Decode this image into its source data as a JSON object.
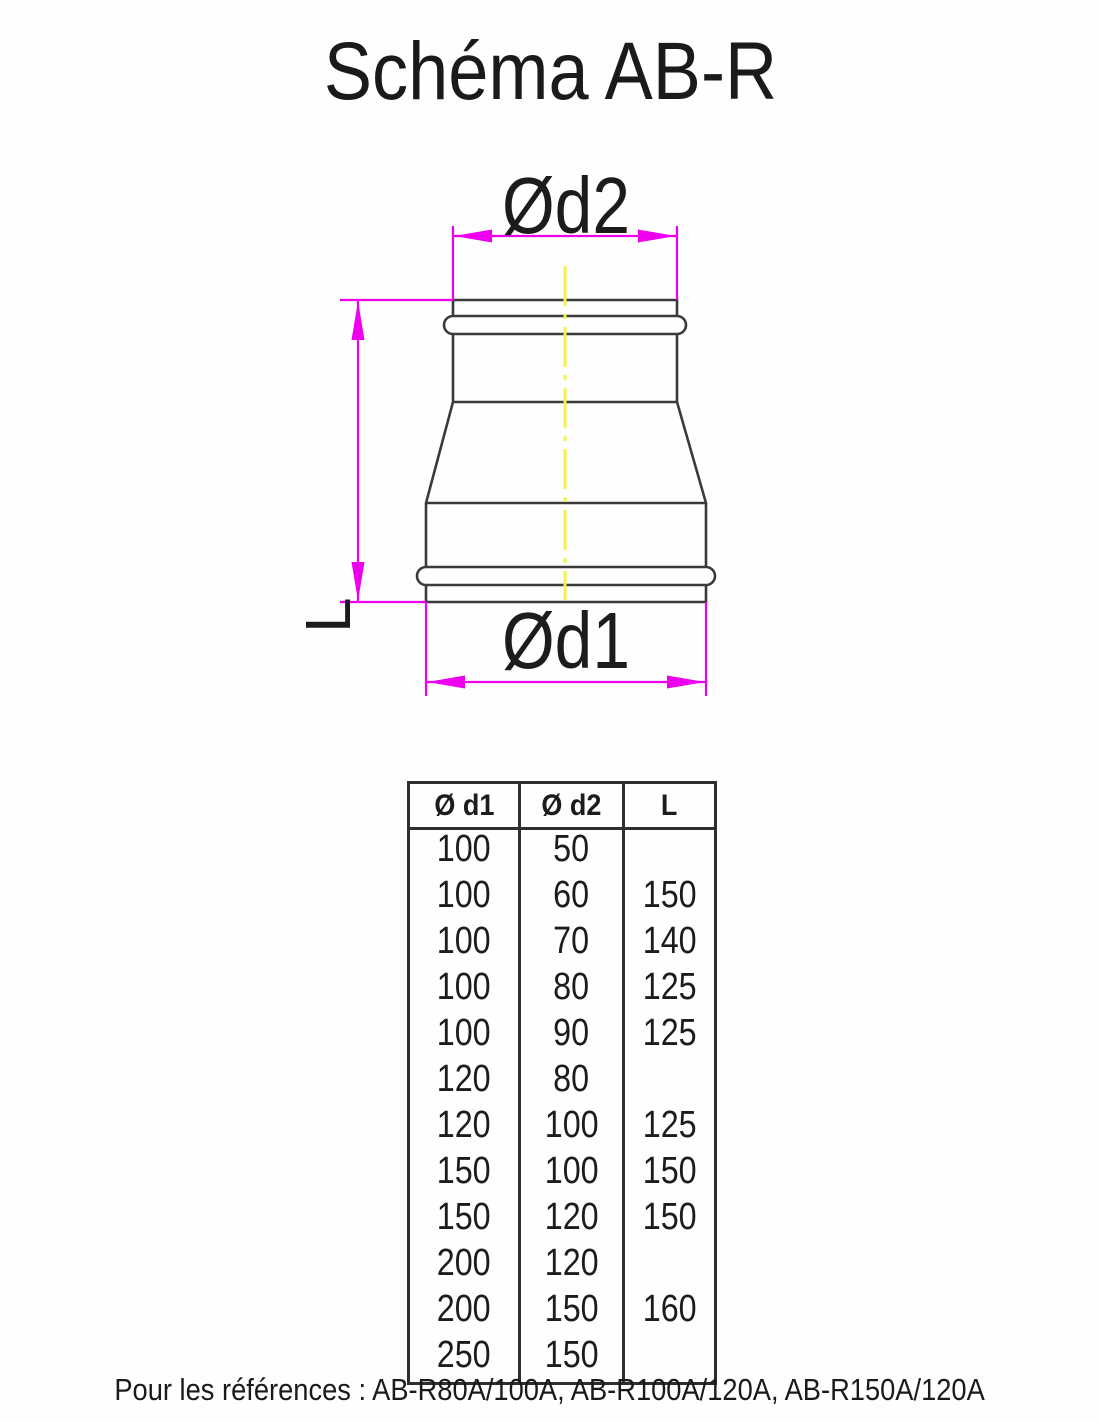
{
  "page": {
    "title": "Schéma AB-R",
    "caption": "Pour les références : AB-R80A/100A, AB-R100A/120A, AB-R150A/120A"
  },
  "diagram": {
    "labels": {
      "d2": "Ød2",
      "d1": "Ød1",
      "length": "L"
    },
    "colors": {
      "dimension": "#ee00ee",
      "centerline": "#f4f446",
      "outline": "#3a3a3a"
    }
  },
  "table": {
    "headers": [
      "Ø d1",
      "Ø d2",
      "L"
    ],
    "rows": [
      [
        "100",
        "50",
        ""
      ],
      [
        "100",
        "60",
        "150"
      ],
      [
        "100",
        "70",
        "140"
      ],
      [
        "100",
        "80",
        "125"
      ],
      [
        "100",
        "90",
        "125"
      ],
      [
        "120",
        "80",
        ""
      ],
      [
        "120",
        "100",
        "125"
      ],
      [
        "150",
        "100",
        "150"
      ],
      [
        "150",
        "120",
        "150"
      ],
      [
        "200",
        "120",
        ""
      ],
      [
        "200",
        "150",
        "160"
      ],
      [
        "250",
        "150",
        ""
      ]
    ]
  }
}
